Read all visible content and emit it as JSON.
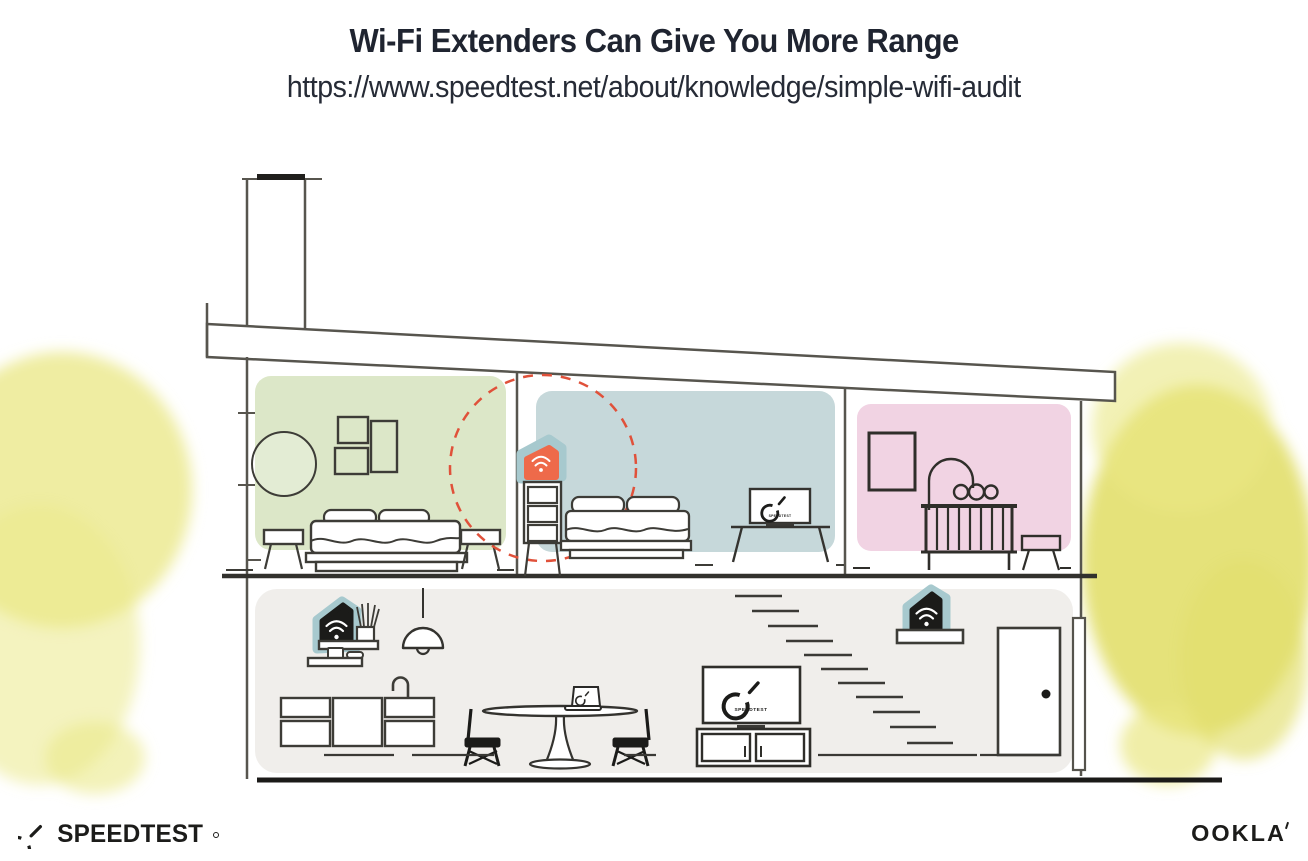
{
  "header": {
    "title": "Wi-Fi Extenders Can Give You More Range",
    "url": "https://www.speedtest.net/about/knowledge/simple-wifi-audit"
  },
  "house": {
    "bedroom_tv_label": "SPEEDTEST",
    "living_tv_label": "SPEEDTEST",
    "icons": [
      "wifi-extender-icon",
      "speedtest-gauge-icon",
      "wifi-waves-icon"
    ],
    "colors": {
      "coverage_dash_red": "#e0513a",
      "extender_orange": "#ee6a4a",
      "extender_teal": "#a7c9ce",
      "extender_black": "#1b1b19",
      "bedroom_green": "#dce7c8",
      "bedroom_blue": "#c6d8da",
      "nursery_pink": "#f1d3e3",
      "lower_floor_gray": "#f0eeeb",
      "watercolor_yellow": "#e7e57c",
      "line_gray": "#57554e"
    }
  },
  "footer": {
    "speedtest_wordmark": "SPEEDTEST",
    "ookla_wordmark": "OOKLA"
  }
}
